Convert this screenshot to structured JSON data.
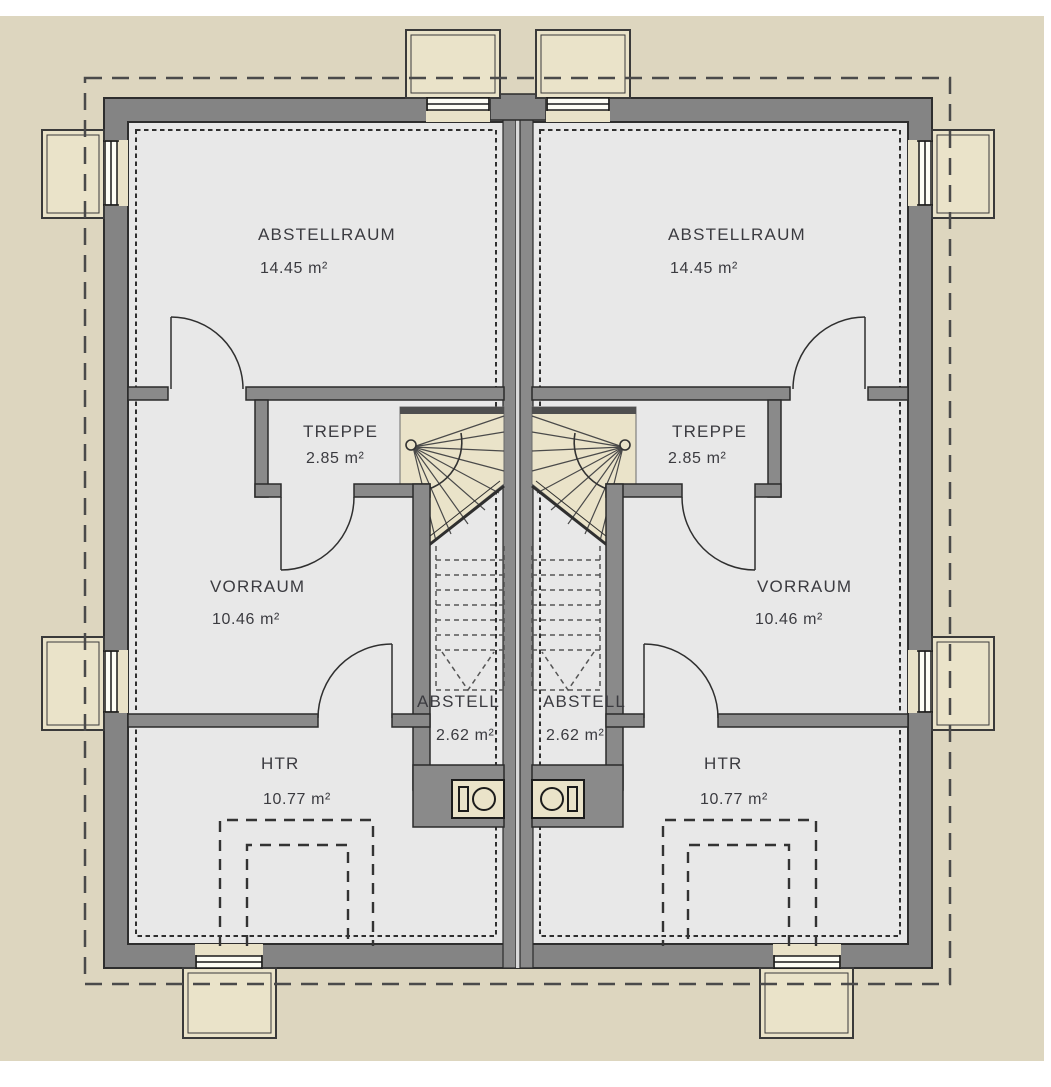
{
  "plan": {
    "type": "floor-plan",
    "language": "de",
    "units": [
      "left-unit",
      "right-unit"
    ]
  },
  "rooms": {
    "abstellraum_left": {
      "name": "ABSTELLRAUM",
      "area": "14.45 m²"
    },
    "abstellraum_right": {
      "name": "ABSTELLRAUM",
      "area": "14.45 m²"
    },
    "treppe_left": {
      "name": "TREPPE",
      "area": "2.85 m²"
    },
    "treppe_right": {
      "name": "TREPPE",
      "area": "2.85 m²"
    },
    "vorraum_left": {
      "name": "VORRAUM",
      "area": "10.46 m²"
    },
    "vorraum_right": {
      "name": "VORRAUM",
      "area": "10.46 m²"
    },
    "abstell_left": {
      "name": "ABSTELL",
      "area": "2.62 m²"
    },
    "abstell_right": {
      "name": "ABSTELL",
      "area": "2.62 m²"
    },
    "htr_left": {
      "name": "HTR",
      "area": "10.77 m²"
    },
    "htr_right": {
      "name": "HTR",
      "area": "10.77 m²"
    }
  },
  "colors": {
    "site_beige": "#ddd6bf",
    "accent_beige": "#eae3c9",
    "interior_grey": "#e8e8e8",
    "wall_grey": "#848484",
    "interior_wall_grey": "#8a8a8a",
    "outline": "#2e2e2e",
    "text": "#3b3b40",
    "paper": "#ffffff"
  }
}
